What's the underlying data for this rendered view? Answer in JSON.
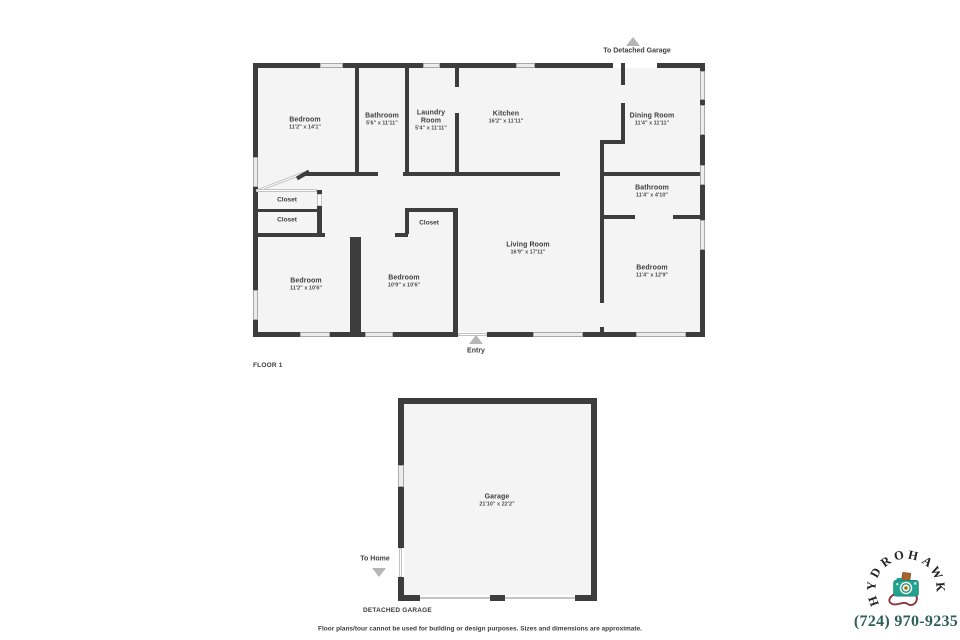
{
  "page": {
    "section1_label": "FLOOR 1",
    "section2_label": "DETACHED GARAGE",
    "disclaimer": "Floor plans/tour cannot be used for building or design purposes. Sizes and dimensions are approximate."
  },
  "floor1": {
    "to_garage_label": "To Detached Garage",
    "entry_label": "Entry",
    "rooms": [
      {
        "name": "Bedroom",
        "dims": "11'2\" x 14'1\""
      },
      {
        "name": "Bathroom",
        "dims": "5'6\" x 11'11\""
      },
      {
        "name": "Laundry Room",
        "dims": "5'4\" x 11'11\""
      },
      {
        "name": "Kitchen",
        "dims": "16'2\" x 11'11\""
      },
      {
        "name": "Dining Room",
        "dims": "11'4\" x 11'11\""
      },
      {
        "name": "Bathroom",
        "dims": "11'4\" x 4'10\""
      },
      {
        "name": "Living Room",
        "dims": "16'9\" x 17'11\""
      },
      {
        "name": "Bedroom",
        "dims": "11'4\" x 12'9\""
      },
      {
        "name": "Bedroom",
        "dims": "11'2\" x 10'6\""
      },
      {
        "name": "Bedroom",
        "dims": "10'9\" x 10'6\""
      }
    ],
    "closets": [
      "Closet",
      "Closet",
      "Closet"
    ]
  },
  "garage": {
    "to_home_label": "To Home",
    "room": {
      "name": "Garage",
      "dims": "21'10\" x 22'2\""
    }
  },
  "watermark": {
    "brand": "HYDRO HAWK",
    "phone": "(724) 970-9235",
    "camera_color": "#21a18f",
    "flash_color": "#a6662e",
    "strap_color": "#8e3040",
    "phone_color": "#2d5f57"
  }
}
